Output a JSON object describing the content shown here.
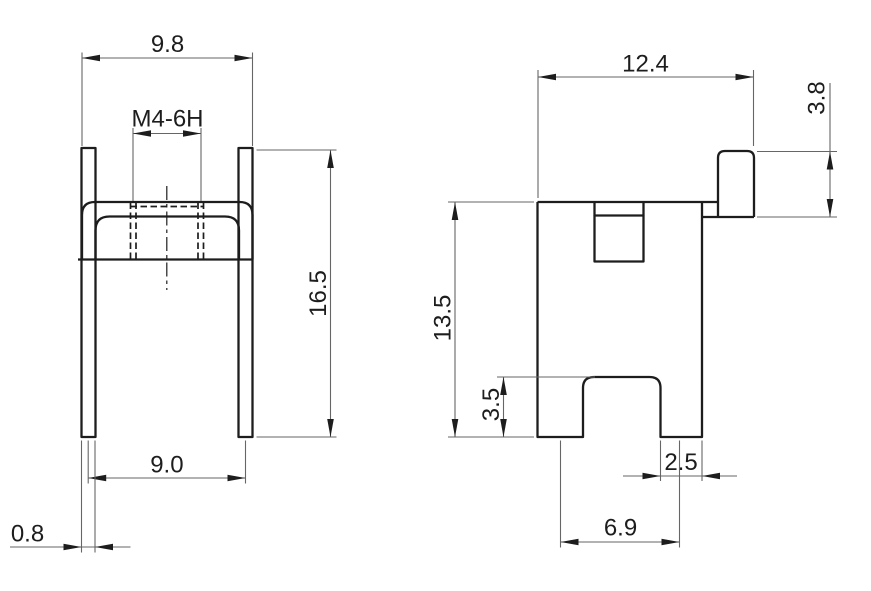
{
  "drawing": {
    "front_view": {
      "width_top": "9.8",
      "thread": "M4-6H",
      "height": "16.5",
      "leg_spacing": "9.0",
      "thickness": "0.8"
    },
    "side_view": {
      "overall_width": "12.4",
      "tab_height": "3.8",
      "body_height": "13.5",
      "notch_height": "3.5",
      "foot_width": "2.5",
      "foot_spacing": "6.9"
    },
    "colors": {
      "background": "#ffffff",
      "object_line": "#1d1d1d",
      "thin_line": "#666666",
      "text": "#1d1d1d"
    }
  }
}
